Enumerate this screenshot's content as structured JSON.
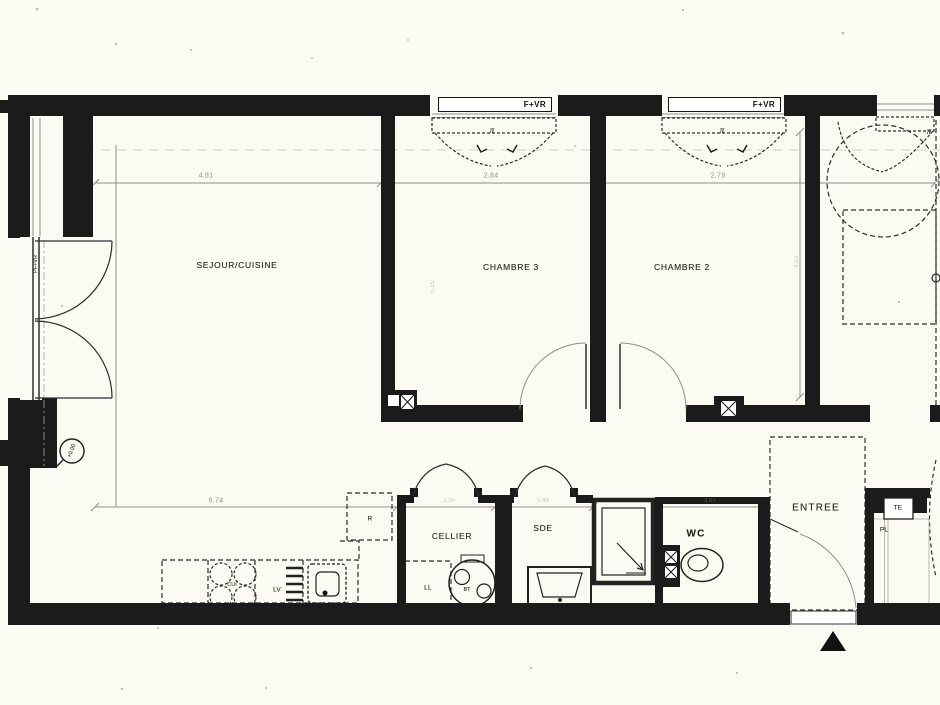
{
  "theme": {
    "paper": "#fbfaf3",
    "wall": "#1b1b1b",
    "line": "#8f8f8f",
    "dash": "#2e2e2e"
  },
  "rooms": {
    "sejour": "SEJOUR/CUISINE",
    "chambre3": "CHAMBRE 3",
    "chambre2": "CHAMBRE 2",
    "cellier": "CELLIER",
    "sde": "SDE",
    "wc": "WC",
    "entree": "ENTREE"
  },
  "openings": {
    "window1": "F+VR",
    "window2": "F+VR",
    "pfvr": "PF+VR",
    "pivot": "π"
  },
  "fixtures": {
    "fridge": "R",
    "washer": "LL",
    "heater": "BT",
    "dishwasher": "LV",
    "hob": "CUI",
    "electrical": "TE",
    "closet": "PL"
  },
  "dims": {
    "sejour_w": "4.81",
    "ch3_w": "2.84",
    "ch2_w": "2.79",
    "bottom_w": "6.74",
    "cellier_w": "1.35",
    "sde_w": "1.49",
    "wc_w": "2.07",
    "ch3_d": "5.15",
    "ch2_d": "3.23"
  },
  "markers": {
    "level": "+0.00"
  }
}
